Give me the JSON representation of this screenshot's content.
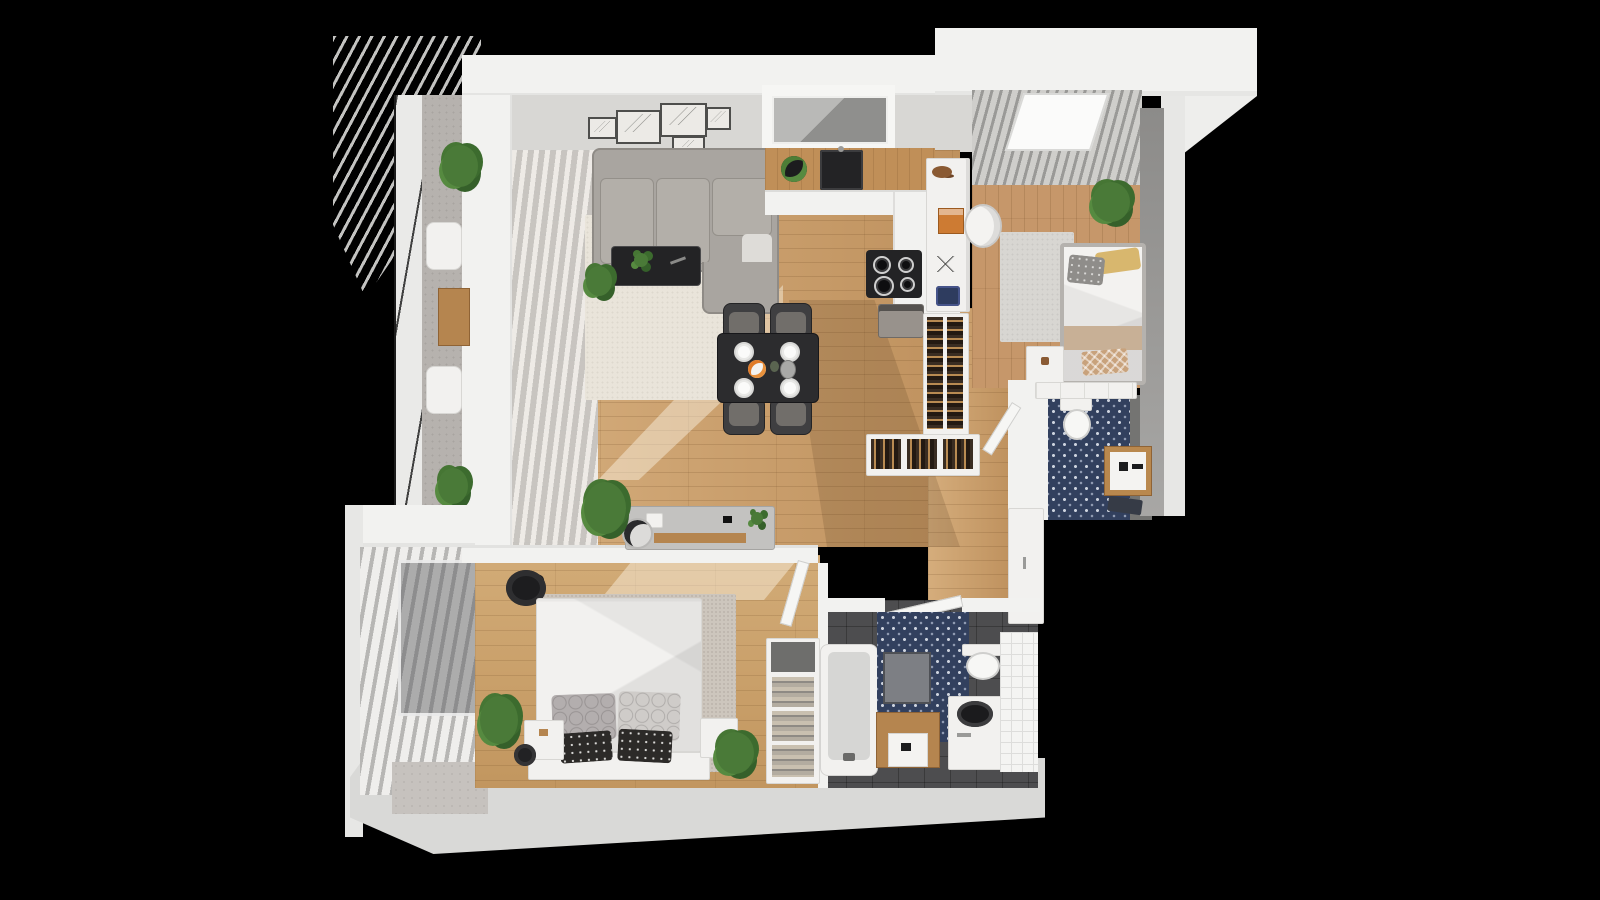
{
  "scene": {
    "kind": "3d-rendered-floor-plan",
    "view": "top-down isometric dollhouse render of a small apartment",
    "background_color": "#000000",
    "has_text": false
  },
  "palette": {
    "outer_wall": "#f2f2f0",
    "interior_wall_face": "#d8d7d4",
    "wood_floor": "#c79a66",
    "balcony_concrete": "#b6b2ae",
    "navy_pattern_tile": "#32405e",
    "dark_tile": "#4d4d4f",
    "white_tile": "#f4f4f2",
    "sofa_gray": "#a9a5a0",
    "dining_black": "#2c2c2e",
    "rug_cream": "#e9e4da",
    "accent_wood": "#b5854f",
    "plant_green": "#4a7a38",
    "pillow_yellow": "#d8b76e",
    "pillow_blue": "#2e3c5f",
    "book_orange": "#cd7b33"
  },
  "rooms": [
    {
      "id": "living-room",
      "features": [
        "gallery wall with 5 framed sketches",
        "L-shaped gray sectional sofa",
        "black media console with plant",
        "cream rug",
        "black dining table with 4 chairs and set plates",
        "vertical blinds along balcony wall"
      ]
    },
    {
      "id": "kitchen",
      "features": [
        "window over counter",
        "black sink",
        "herb tray",
        "induction cooktop with 4 burners",
        "coffee machine",
        "book shelving peninsula full of books"
      ]
    },
    {
      "id": "office-bedroom",
      "features": [
        "long white desk with orange book and resting cat",
        "white desk chair",
        "single bed with yellow and gray pillows",
        "nightstand",
        "gray curtains with skylight",
        "potted plant",
        "gray rug"
      ]
    },
    {
      "id": "small-bathroom",
      "features": [
        "navy moroccan tile floor",
        "toilet",
        "wood-framed vanity with sink",
        "dark towel",
        "white shelf row"
      ]
    },
    {
      "id": "hallway",
      "features": [
        "gray entry bench with wooden shelf",
        "round basket",
        "fern plant",
        "entry closet door"
      ]
    },
    {
      "id": "main-bedroom",
      "features": [
        "double bed with patterned pillows",
        "two white nightstands",
        "plants",
        "black arc lamp",
        "warm gray rug",
        "slatted window blinds to balcony"
      ]
    },
    {
      "id": "main-bathroom",
      "features": [
        "bathtub",
        "towel shelf column with rolled towels",
        "navy patterned wall with mirror",
        "wooden vanity with white sink",
        "top-load washing machine",
        "toilet",
        "white tiled wall",
        "dark tile floor"
      ]
    },
    {
      "id": "upper-balcony",
      "features": [
        "slatted pergola canopy",
        "glass railing",
        "two white chairs",
        "small wooden table",
        "plants"
      ]
    },
    {
      "id": "lower-balcony",
      "features": [
        "white louvered shutters",
        "windows",
        "concrete floor"
      ]
    }
  ],
  "object_counts": {
    "plants": 9,
    "doors_open": 3,
    "beds": 2,
    "bathrooms": 2,
    "balconies": 2
  }
}
